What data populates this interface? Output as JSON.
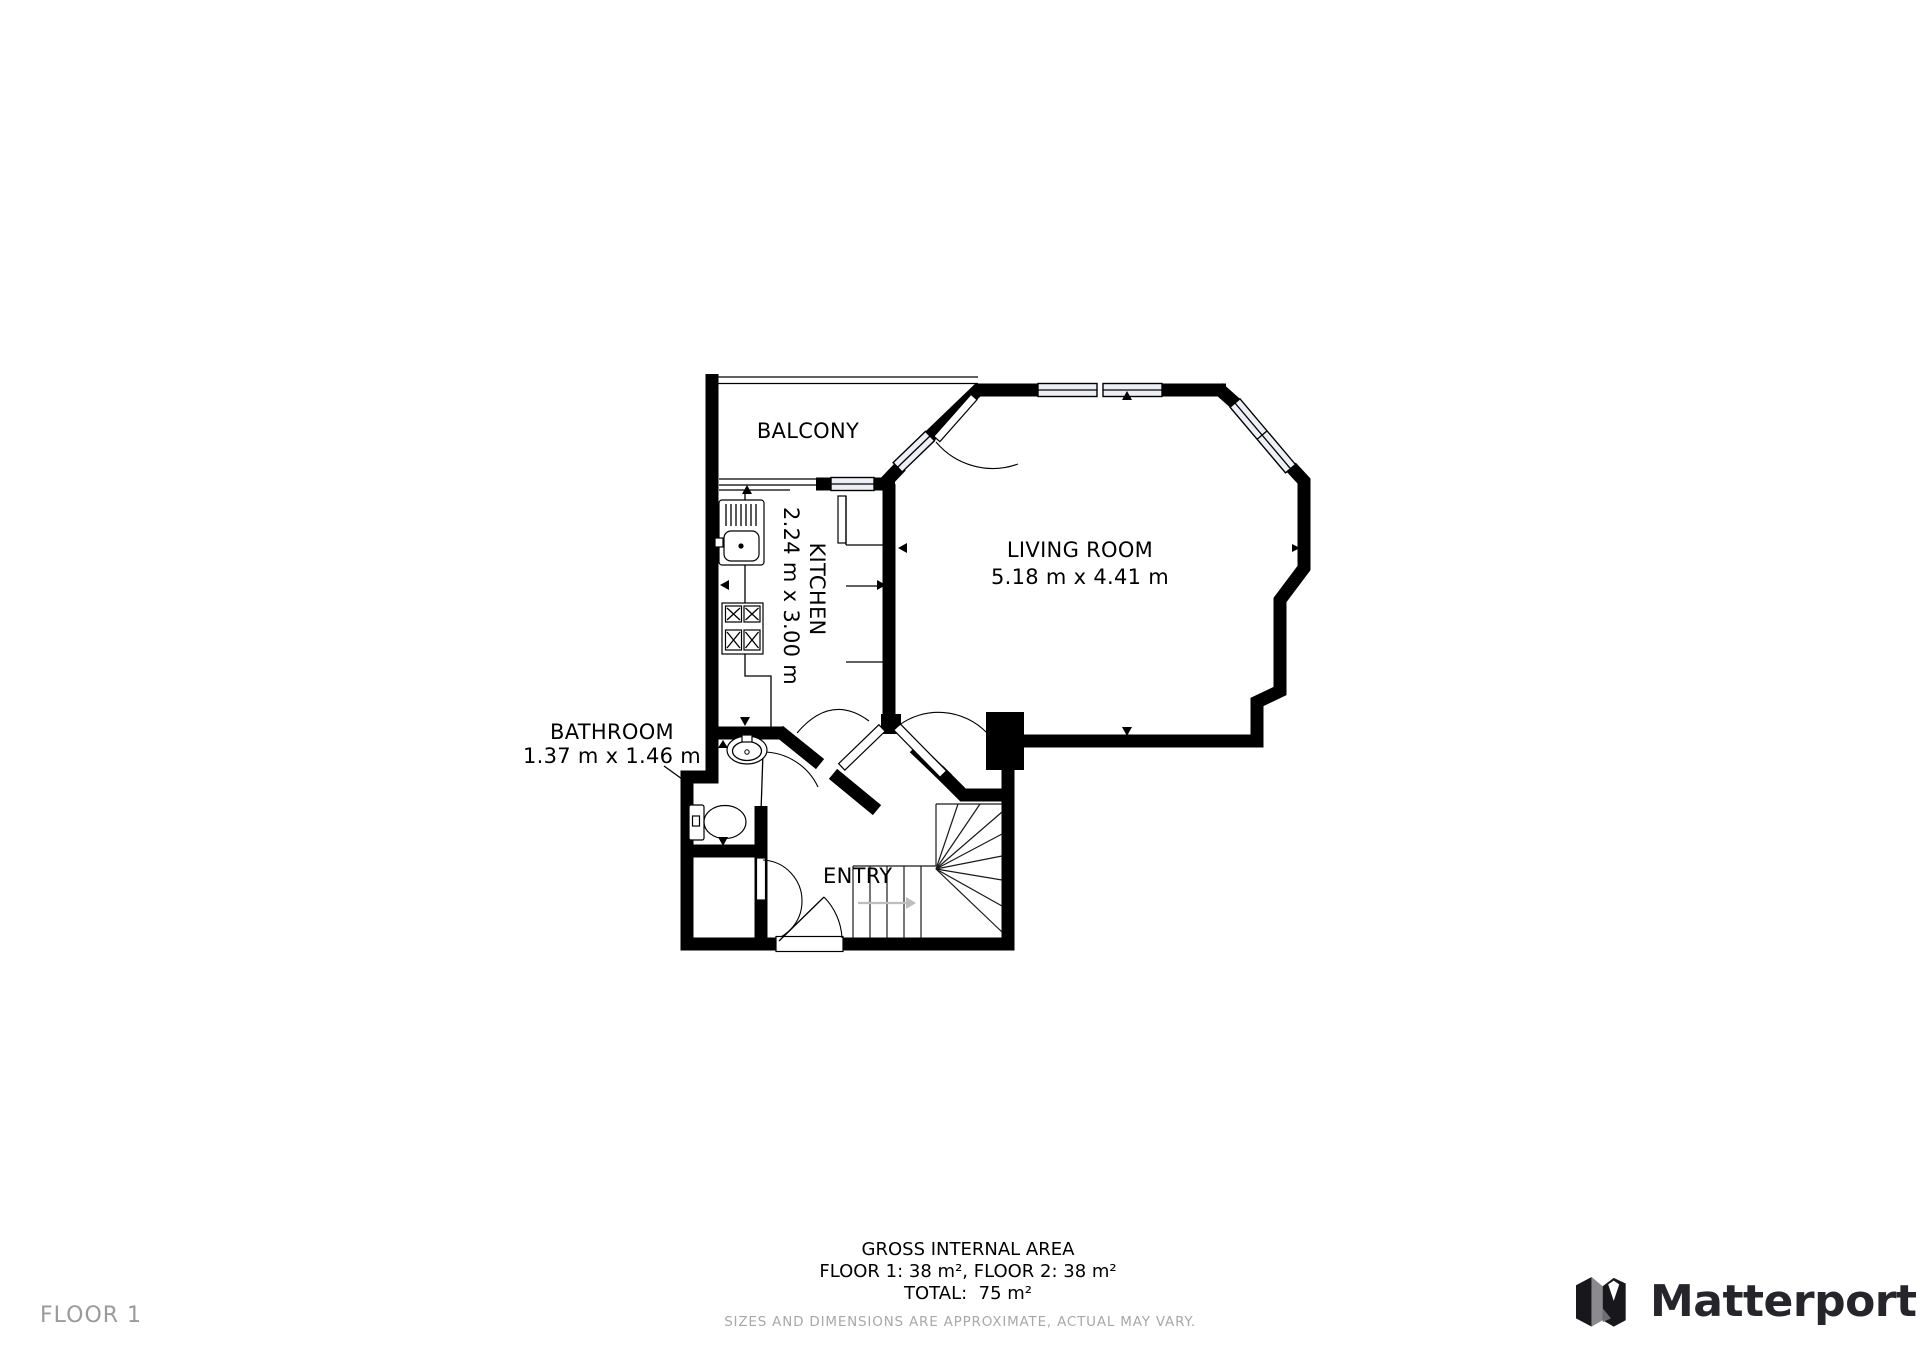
{
  "plan": {
    "rooms": {
      "balcony": {
        "name": "BALCONY"
      },
      "living": {
        "name": "LIVING ROOM",
        "dims": "5.18 m x 4.41 m"
      },
      "kitchen": {
        "name": "KITCHEN",
        "dims": "2.24 m x 3.00 m"
      },
      "bathroom": {
        "name": "BATHROOM",
        "dims": "1.37 m x 1.46 m"
      },
      "entry": {
        "name": "ENTRY"
      }
    }
  },
  "footer": {
    "area_title": "GROSS INTERNAL AREA",
    "area_floors": "FLOOR 1: 38 m², FLOOR 2: 38 m²",
    "area_total": "TOTAL:  75 m²",
    "disclaimer": "SIZES AND DIMENSIONS ARE APPROXIMATE, ACTUAL MAY VARY.",
    "floor_label": "FLOOR 1",
    "brand": "Matterport"
  },
  "colors": {
    "wall": "#000000",
    "window_fill": "#edeff7",
    "muted_text": "#9a9a9a",
    "disclaimer_text": "#a8a8a8",
    "brand_text": "#25252b"
  }
}
